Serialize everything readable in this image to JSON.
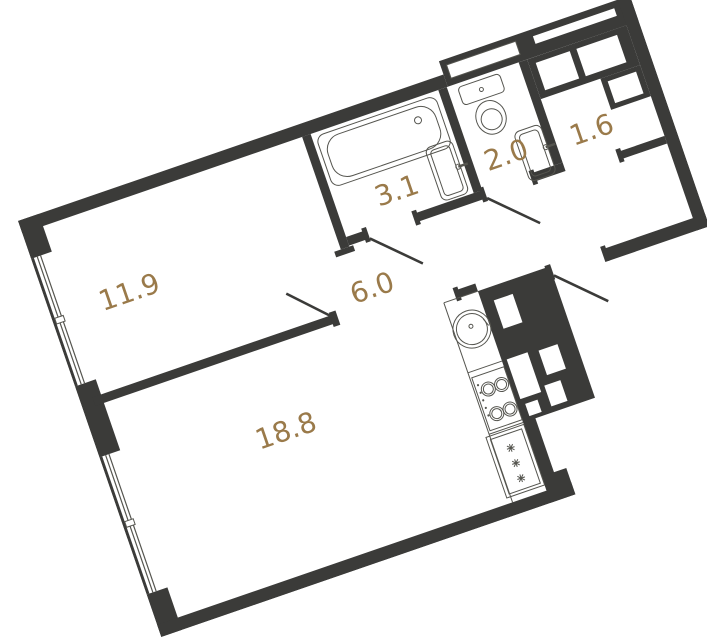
{
  "plan_title": "apartment-floor-plan",
  "rooms": {
    "bedroom": {
      "label": "11.9"
    },
    "living": {
      "label": "18.8"
    },
    "hallway": {
      "label": "6.0"
    },
    "bathroom": {
      "label": "3.1"
    },
    "wc": {
      "label": "2.0"
    },
    "closet": {
      "label": "1.6"
    }
  },
  "fixtures": [
    "bathtub",
    "bathroom-sink",
    "toilet",
    "wc-sink",
    "kitchen-counter",
    "kitchen-sink",
    "stove",
    "fridge",
    "window",
    "window",
    "entry-door",
    "interior-doors",
    "ventilation-shafts"
  ],
  "fridge_snowflake_count": 3,
  "palette": {
    "wall": "#3b3b39",
    "fixture_line": "#55554f",
    "label_text": "#9a7a4a",
    "background": "#ffffff"
  },
  "rotation_deg": -19
}
